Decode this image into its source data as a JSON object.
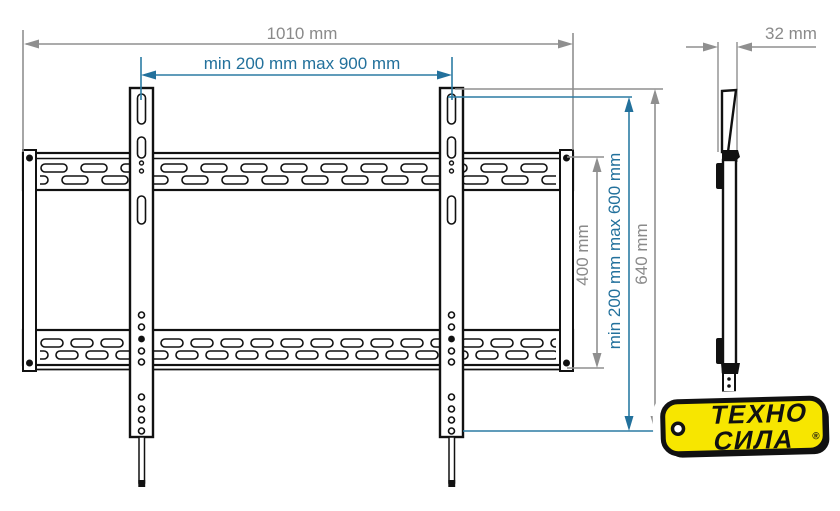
{
  "drawing": {
    "front_view": {
      "dim_width_total": "1010 mm",
      "dim_width_range": "min 200 mm max 900 mm",
      "dim_height_plate": "400 mm",
      "dim_height_range": "min 200 mm max 600 mm",
      "dim_height_total": "640 mm"
    },
    "side_view": {
      "dim_depth": "32 mm"
    }
  },
  "logo": {
    "line1": "ТЕХНО",
    "line2": "СИЛА",
    "registered": "®"
  },
  "colors": {
    "dim_gray": "#8a8a8a",
    "dim_blue": "#23719c",
    "line_black": "#111111",
    "logo_yellow": "#f7e600"
  }
}
